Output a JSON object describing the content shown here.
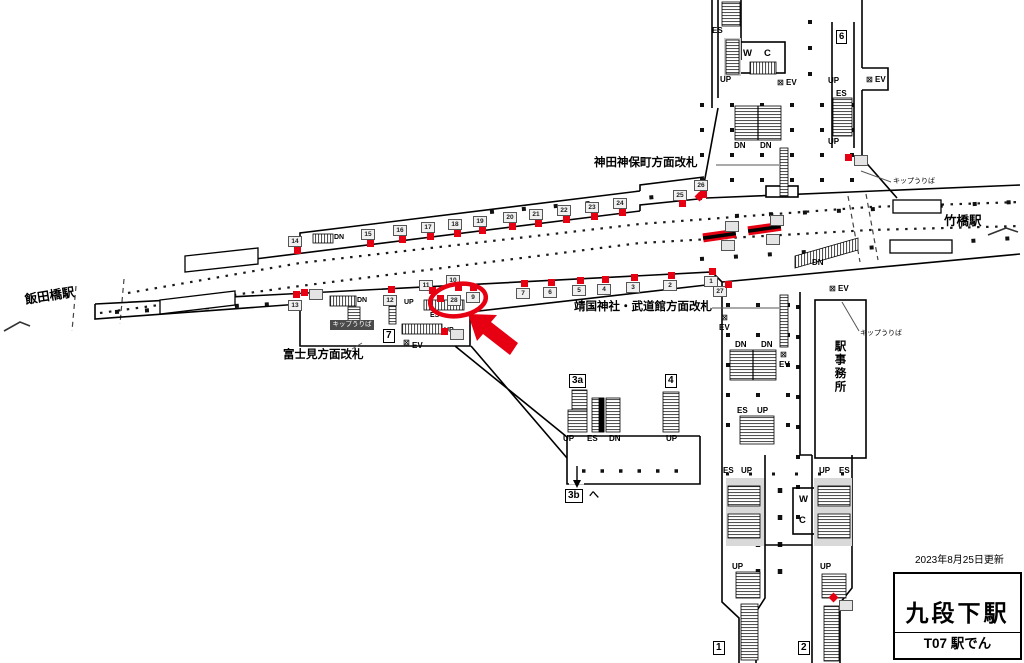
{
  "info": {
    "updated": "2023年8月25日更新",
    "line_name": "東西線",
    "station_name": "九段下駅",
    "station_code": "T07 駅でん"
  },
  "colors": {
    "red": "#e60012",
    "line_blue": "#00a0d8"
  },
  "stations": {
    "left": "飯田橋駅",
    "right": "竹橋駅"
  },
  "gates": {
    "north": "神田神保町方面改札",
    "south": "靖国神社・武道館方面改札",
    "west": "富士見方面改札"
  },
  "rooms": {
    "office": "駅事務所",
    "ticket": "キップうりば",
    "wc_w": "W",
    "wc_c": "C"
  },
  "dir": {
    "up": "UP",
    "dn": "DN",
    "es": "ES",
    "ev": "EV"
  },
  "icons": {
    "ev_box": "⊠",
    "down_arrow": "↓"
  },
  "exits": {
    "e1": "1",
    "e2": "2",
    "e3a": "3a",
    "e3b": "3b",
    "e3b_suffix": "へ",
    "e4": "4",
    "e6": "6",
    "e7": "7"
  },
  "panels": {
    "top": [
      [
        "14",
        288,
        236,
        294,
        247
      ],
      [
        "15",
        361,
        229,
        367,
        240
      ],
      [
        "16",
        393,
        225,
        399,
        236
      ],
      [
        "17",
        421,
        222,
        427,
        233
      ],
      [
        "18",
        448,
        219,
        454,
        230
      ],
      [
        "19",
        473,
        216,
        479,
        227
      ],
      [
        "20",
        503,
        212,
        509,
        223
      ],
      [
        "21",
        529,
        209,
        535,
        220
      ],
      [
        "22",
        557,
        205,
        563,
        216
      ],
      [
        "23",
        585,
        202,
        591,
        213
      ],
      [
        "24",
        613,
        198,
        619,
        209
      ],
      [
        "25",
        673,
        190,
        679,
        200
      ],
      [
        "26",
        694,
        180,
        700,
        191
      ]
    ],
    "bottom": [
      [
        "1",
        704,
        276,
        709,
        268
      ],
      [
        "2",
        663,
        280,
        668,
        272
      ],
      [
        "3",
        626,
        282,
        631,
        274
      ],
      [
        "4",
        597,
        284,
        602,
        276
      ],
      [
        "5",
        572,
        285,
        577,
        277
      ],
      [
        "6",
        543,
        287,
        548,
        279
      ],
      [
        "7",
        516,
        288,
        521,
        280
      ],
      [
        "9",
        466,
        292,
        470,
        284
      ],
      [
        "10",
        446,
        275,
        455,
        284
      ],
      [
        "11",
        419,
        280,
        429,
        287
      ],
      [
        "12",
        383,
        295,
        388,
        286
      ],
      [
        "13",
        288,
        300,
        293,
        291
      ],
      [
        "27",
        713,
        286,
        725,
        281
      ]
    ],
    "highlight": [
      "28",
      447,
      295,
      437,
      295
    ],
    "small_boxes": [
      [
        309,
        289
      ],
      [
        450,
        329
      ],
      [
        854,
        155
      ],
      [
        839,
        600
      ],
      [
        725,
        221
      ],
      [
        721,
        240
      ],
      [
        770,
        215
      ],
      [
        766,
        234
      ]
    ],
    "red_squares": [
      [
        301,
        289,
        0
      ],
      [
        441,
        328,
        0
      ],
      [
        845,
        154,
        0
      ],
      [
        830,
        594,
        1
      ],
      [
        696,
        193,
        1
      ]
    ]
  }
}
